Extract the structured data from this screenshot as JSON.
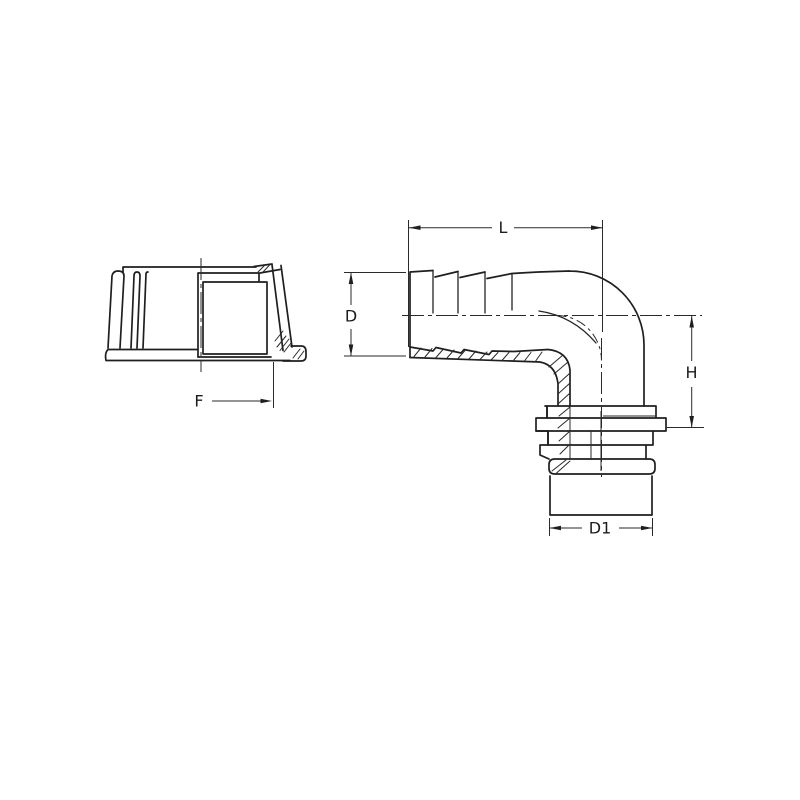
{
  "drawing": {
    "type": "technical-dimension-drawing",
    "part": "90-degree hose barb elbow fitting with nut side view",
    "background_color": "#ffffff",
    "line_color": "#1f1f1f"
  },
  "labels": {
    "length": "L",
    "diameter": "D",
    "height": "H",
    "outlet_diameter": "D1",
    "face_width": "F"
  }
}
